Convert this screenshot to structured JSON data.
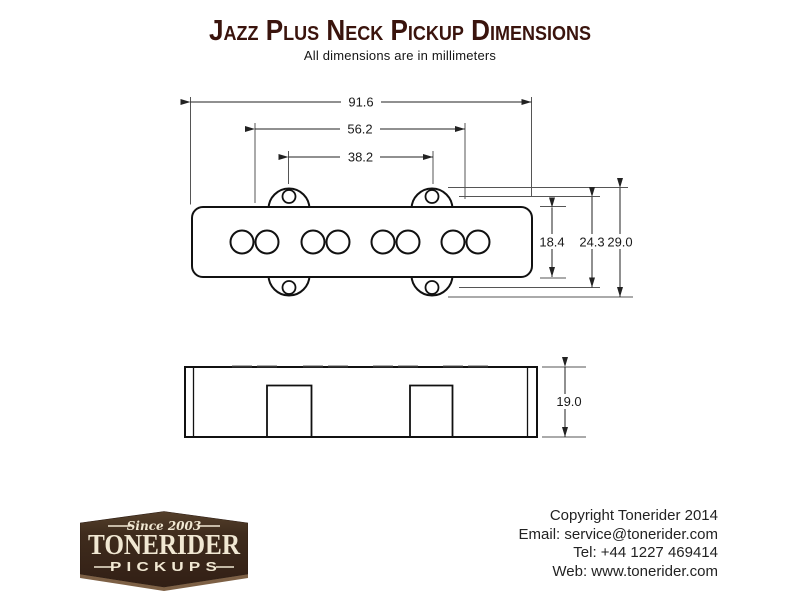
{
  "page": {
    "title": "Jazz Plus Neck Pickup Dimensions",
    "subtitle": "All dimensions are in millimeters"
  },
  "drawing": {
    "units": "millimeters",
    "dimensions": {
      "overall_width": "91.6",
      "mount_ear_width": "56.2",
      "screw_spacing": "38.2",
      "body_height": "18.4",
      "screw_hole_vertical_spacing": "24.3",
      "overall_height": "29.0",
      "side_depth": "19.0"
    }
  },
  "logo": {
    "since": "Since 2003",
    "brand": "TONERIDER",
    "product": "PICKUPS"
  },
  "footer": {
    "lines": [
      "Copyright Tonerider 2014",
      "Email: service@tonerider.com",
      "Tel: +44 1227 469414",
      "Web: www.tonerider.com"
    ]
  },
  "colors": {
    "title_text": "#3a140d",
    "logo_background": "#3e2b1d",
    "logo_text": "#f1e8d3",
    "drawing_line": "#1a1a1a"
  }
}
